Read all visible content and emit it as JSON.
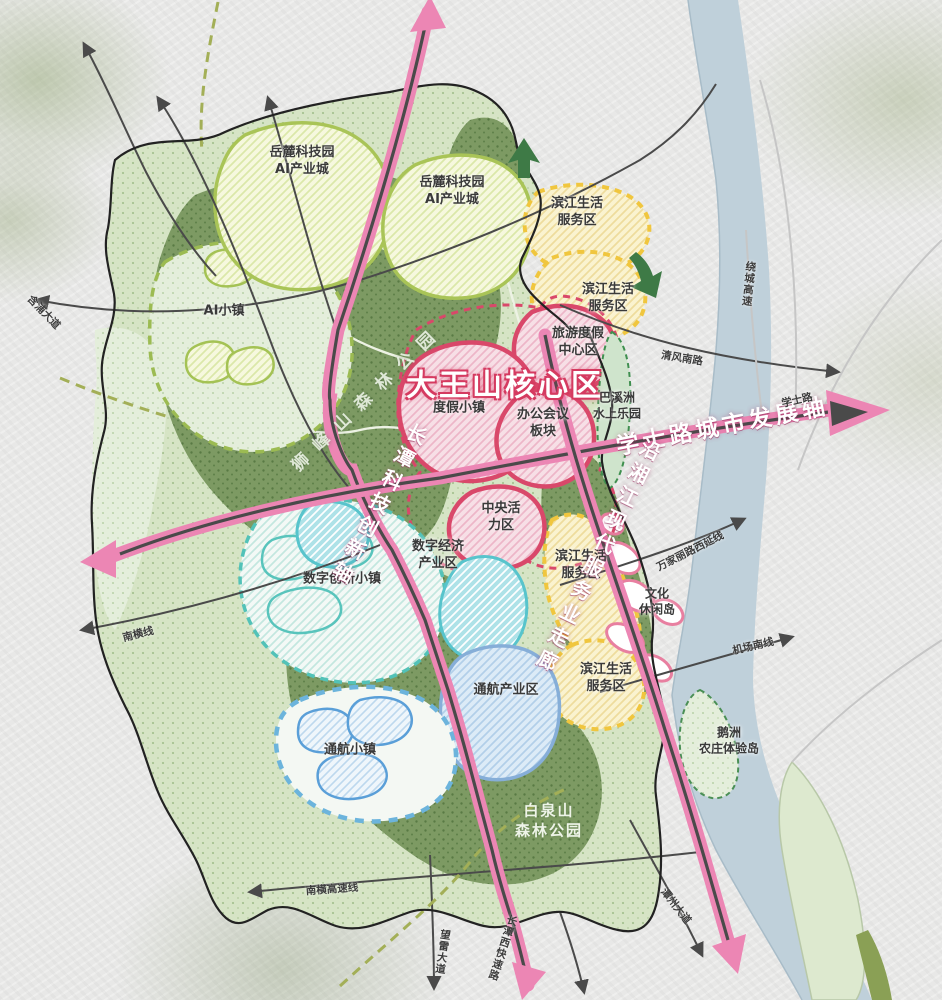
{
  "map_type": "urban-planning-map",
  "colors": {
    "axis_pink": "#ec86b4",
    "corridor_core": "#4a4a4a",
    "zone_red_border": "#d9486a",
    "zone_yellow_border": "#f0c63e",
    "zone_green_border": "#a9c457",
    "zone_teal_border": "#52c2b8",
    "zone_blue_border": "#86aed8",
    "river_blue": "#bfd0da",
    "forest_green": "#7d9a63",
    "boundary_black": "#222222",
    "arrow_green": "#3e7a46"
  },
  "regions": [
    {
      "name": "yuelu-tech-park-ai-city-west",
      "label": "岳麓科技园\nAI产业城"
    },
    {
      "name": "yuelu-tech-park-ai-city-east",
      "label": "岳麓科技园\nAI产业城"
    },
    {
      "name": "ai-town",
      "label": "AI小镇"
    },
    {
      "name": "binjiang-life-service-north-1",
      "label": "滨江生活\n服务区"
    },
    {
      "name": "binjiang-life-service-north-2",
      "label": "滨江生活\n服务区"
    },
    {
      "name": "tourism-resort-center",
      "label": "旅游度假\n中心区"
    },
    {
      "name": "dawangshan-core-area",
      "label": "大王山核心区"
    },
    {
      "name": "resort-town",
      "label": "度假小镇"
    },
    {
      "name": "office-conference-block",
      "label": "办公会议\n板块"
    },
    {
      "name": "baxizhou-water-park",
      "label": "巴溪洲\n水上乐园"
    },
    {
      "name": "central-vitality-zone",
      "label": "中央活\n力区"
    },
    {
      "name": "digital-economy-industry-zone",
      "label": "数字经济\n产业区"
    },
    {
      "name": "digital-innovation-town",
      "label": "数字创新小镇"
    },
    {
      "name": "binjiang-life-service-mid",
      "label": "滨江生活\n服务区"
    },
    {
      "name": "culture-leisure-island",
      "label": "文化\n休闲岛"
    },
    {
      "name": "binjiang-life-service-south",
      "label": "滨江生活\n服务区"
    },
    {
      "name": "general-aviation-industry-zone",
      "label": "通航产业区"
    },
    {
      "name": "general-aviation-town",
      "label": "通航小镇"
    },
    {
      "name": "baiquanshan-forest-park",
      "label": "白泉山\n森林公园"
    },
    {
      "name": "shifengshan-forest-park",
      "label": "狮峰山森林公园"
    },
    {
      "name": "ezhou-farm-experience-island",
      "label": "鹅洲\n农庄体验岛"
    }
  ],
  "axes": [
    {
      "name": "xueshi-road-urban-development-axis",
      "label": "学士路城市发展轴"
    },
    {
      "name": "changtan-sci-tech-innovation-axis",
      "label": "长潭科技创新轴"
    },
    {
      "name": "riverside-modern-service-corridor",
      "label": "沿湘江现代服务业走廊"
    }
  ],
  "roads": [
    {
      "name": "hanpu-avenue",
      "label": "含浦大道"
    },
    {
      "name": "nanheng-line",
      "label": "南横线"
    },
    {
      "name": "nanheng-expressway",
      "label": "南横高速线"
    },
    {
      "name": "wanglei-avenue",
      "label": "望雷大道"
    },
    {
      "name": "changtan-west-expressway",
      "label": "长潭西快速路"
    },
    {
      "name": "tanzhou-avenue",
      "label": "潭州大道"
    },
    {
      "name": "airport-south-line",
      "label": "机场南线"
    },
    {
      "name": "wanjiali-road-west-extension",
      "label": "万家丽路西延线"
    },
    {
      "name": "qingfeng-south-road",
      "label": "清风南路"
    },
    {
      "name": "ring-expressway",
      "label": "绕城高速"
    },
    {
      "name": "xueshi-road",
      "label": "学士路"
    }
  ]
}
